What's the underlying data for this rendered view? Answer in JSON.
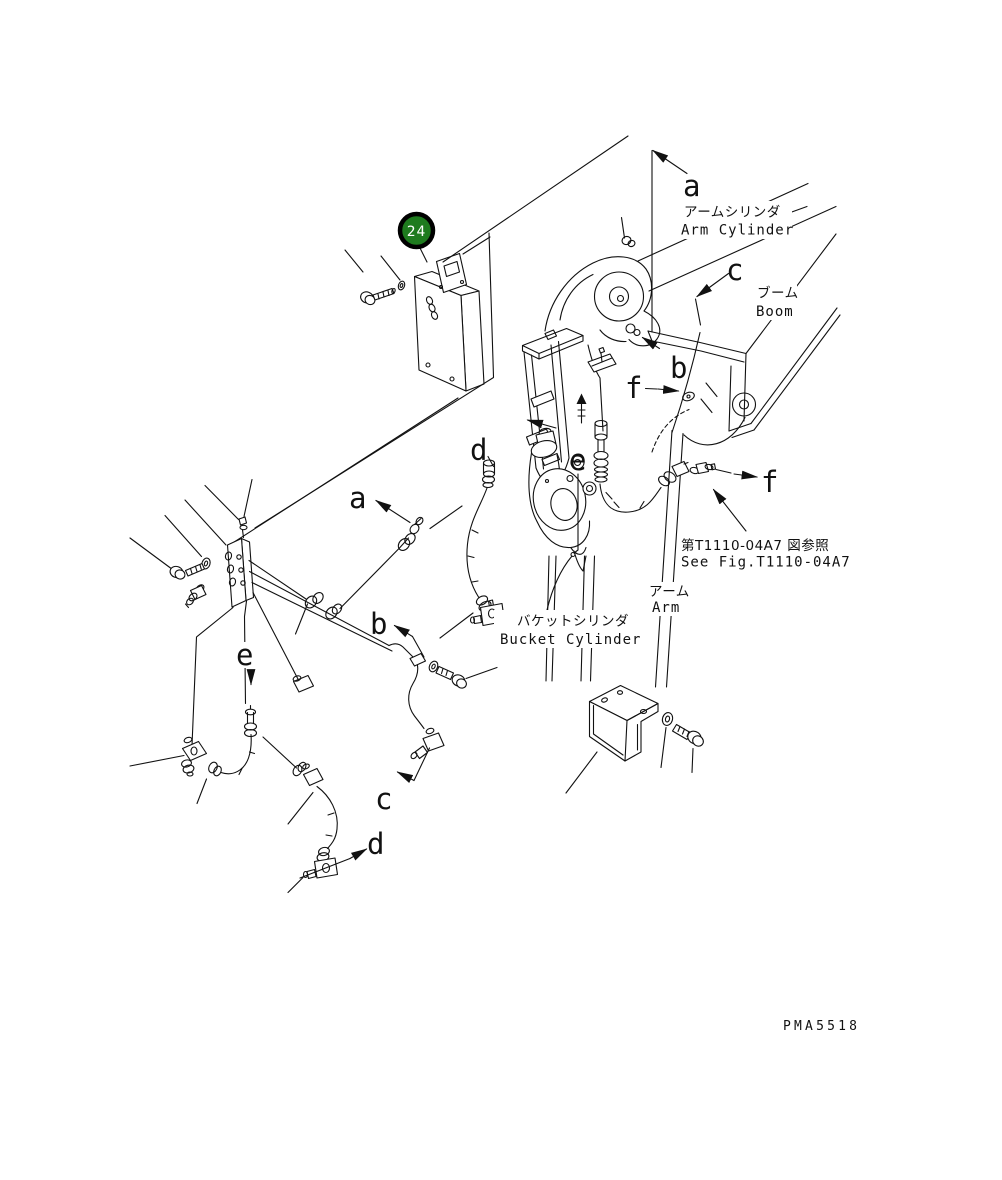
{
  "diagram": {
    "drawing_code": "PMA5518",
    "balloon": {
      "number": "24",
      "fill": "#1e7b1e"
    },
    "callouts": {
      "a_top": "a",
      "c_top": "c",
      "b_top": "b",
      "f_left": "f",
      "d_top": "d",
      "e_mid": "e",
      "f_right": "f",
      "a_left": "a",
      "b_left": "b",
      "e_left": "e",
      "c_bottom": "c",
      "d_bottom": "d"
    },
    "labels": {
      "arm_cylinder": {
        "ja": "アームシリンダ",
        "en": "Arm Cylinder"
      },
      "boom": {
        "ja": "ブーム",
        "en": "Boom"
      },
      "bucket_cylinder": {
        "ja": "バケットシリンダ",
        "en": "Bucket Cylinder"
      },
      "arm": {
        "ja": "アーム",
        "en": "Arm"
      }
    },
    "reference": {
      "ja": "第T1110-04A7 図参照",
      "en": "See Fig.T1110-04A7"
    }
  }
}
